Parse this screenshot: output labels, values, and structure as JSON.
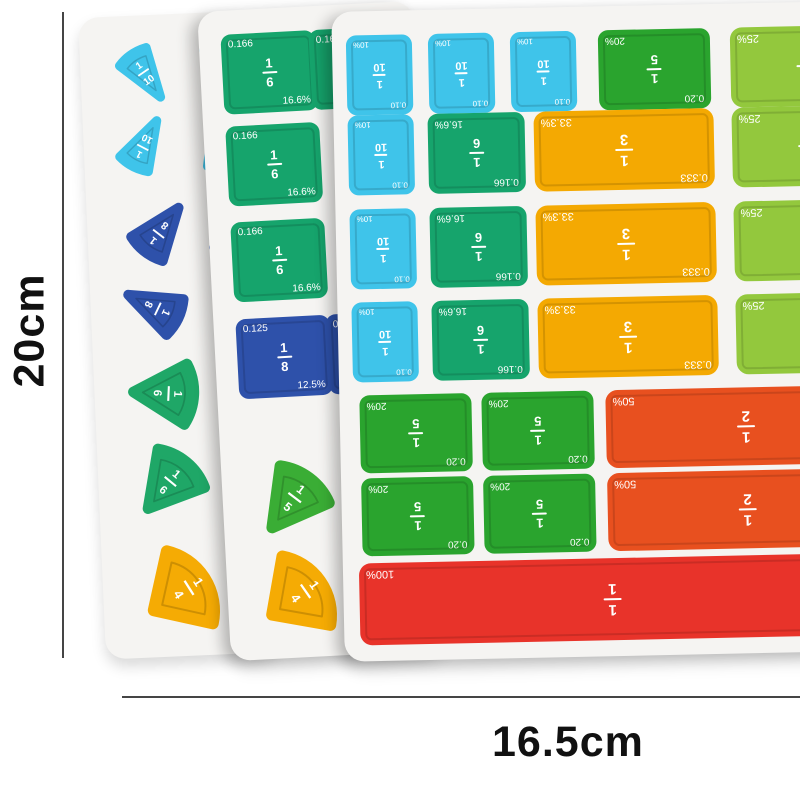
{
  "annotations": {
    "height_label": "20cm",
    "width_label": "16.5cm"
  },
  "fractions": {
    "one": {
      "num": "1",
      "den": "1",
      "pct": "100%"
    },
    "half": {
      "num": "1",
      "den": "2",
      "pct": "50%"
    },
    "third": {
      "num": "1",
      "den": "3",
      "dec": "0.333",
      "pct": "33.3%"
    },
    "quarter": {
      "num": "1",
      "den": "4",
      "pct": "25%"
    },
    "fifth": {
      "num": "1",
      "den": "5",
      "dec": "0.20",
      "pct": "20%"
    },
    "sixth": {
      "num": "1",
      "den": "6",
      "dec": "0.166",
      "pct": "16.6%"
    },
    "eighth": {
      "num": "1",
      "den": "8",
      "dec": "0.125",
      "pct": "12.5%"
    },
    "tenth": {
      "num": "1",
      "den": "10",
      "dec": "0.10",
      "pct": "10%"
    }
  },
  "colors": {
    "tenth": "#3fc4ea",
    "eighth": "#2e51aa",
    "sixth": "#16a46c",
    "sixth_wedge": "#1fa767",
    "fifth": "#2aa42e",
    "fifth_wedge": "#3aad35",
    "third": "#f4a902",
    "quarter_square": "#93c83d",
    "quarter_wedge": "#f5ab04",
    "half": "#e8501f",
    "one": "#e8332a",
    "board": "#f5f4f2",
    "dimension_line": "#454545",
    "dimension_text": "#111111"
  }
}
